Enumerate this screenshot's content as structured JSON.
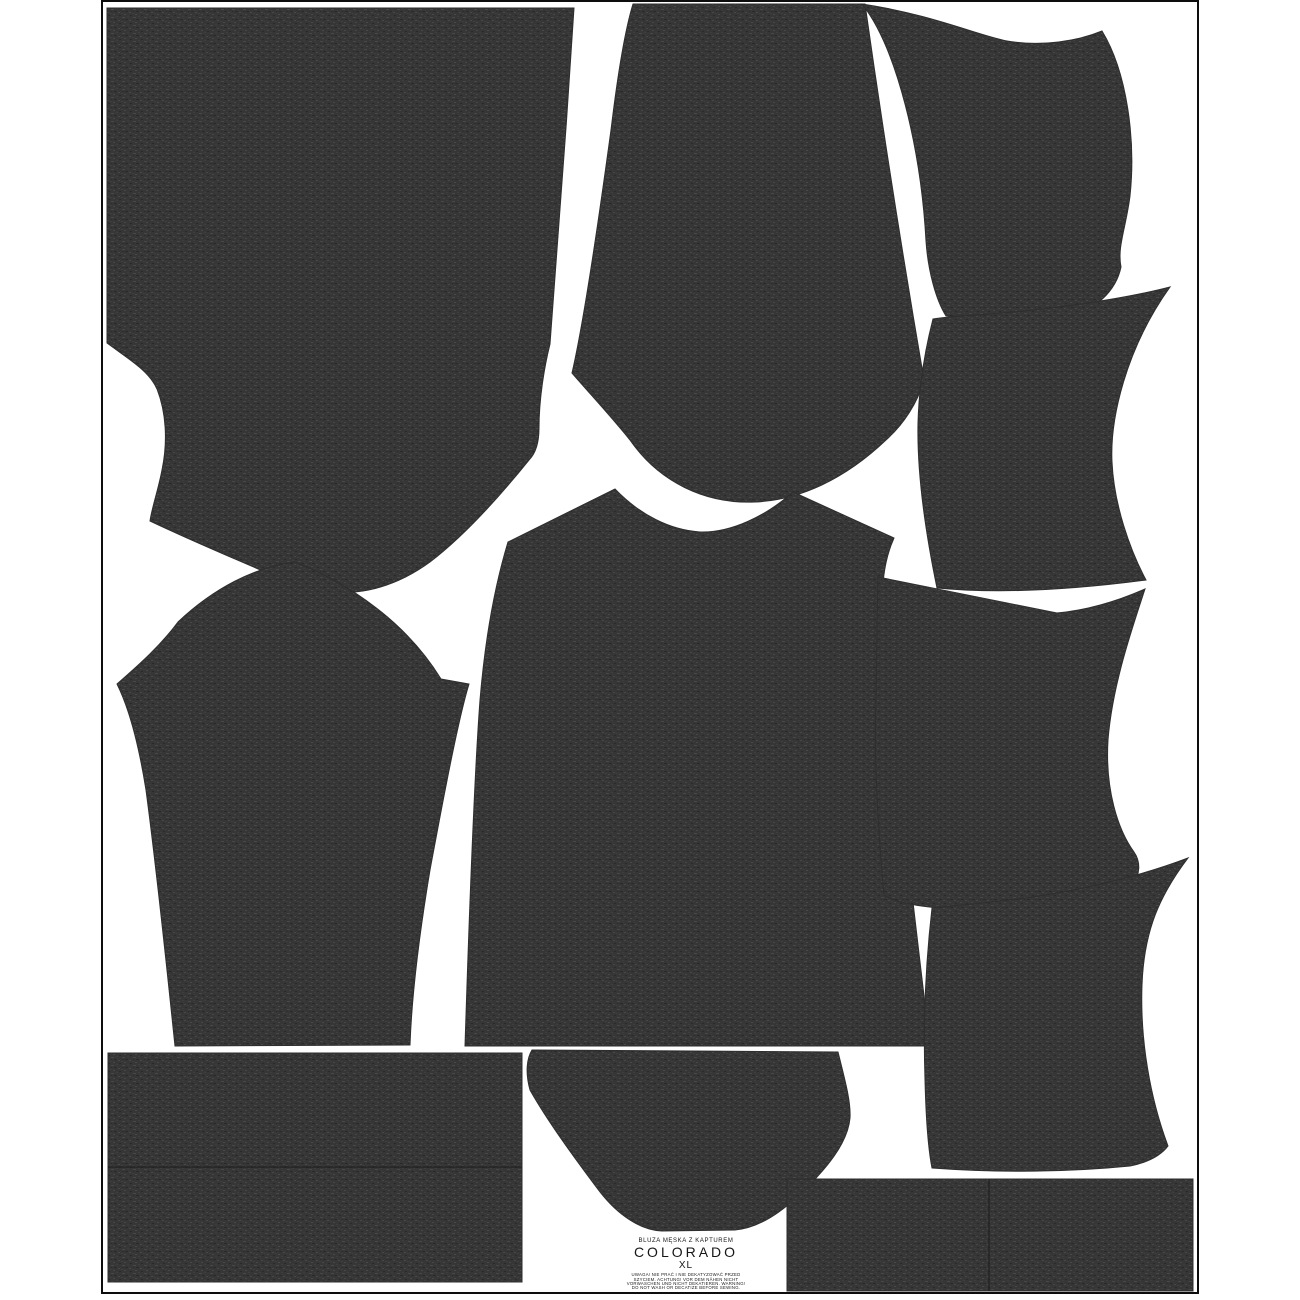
{
  "page": {
    "title": "COLORADO XL cut-and-sew hoodie panel",
    "background_color": "#ffffff",
    "border_color": "#0d0d0d",
    "fabric_base_color": "#363636",
    "fabric_speck_light": "#484848",
    "fabric_speck_mid": "#3e3e3e",
    "fabric_speck_dark": "#2a2a2a",
    "seam_line_color": "#1c1c1c"
  },
  "label_block": {
    "garment": "BLUZA MĘSKA Z KAPTUREM",
    "pattern_name": "COLORADO",
    "size": "XL",
    "care_lines": [
      "UWAGA! NIE PRAĆ I NIE DEKATYZOWAĆ PRZED",
      "SZYCIEM. ACHTUNG! VOR DEM NÄHEN NICHT",
      "VORWASCHEN UND NICHT DEKATIEREN. WARNING!",
      "DO NOT WASH OR DECATIZE BEFORE SEWING."
    ]
  },
  "border": {
    "x": 102,
    "y": 1,
    "width": 1096,
    "height": 1292
  },
  "pieces": [
    {
      "id": "back-panel",
      "path": "M 111,8 L 574,8 C 567,120 558,240 550,344 C 544,368 539,400 539,428 C 539,446 534,455 529,460 C 500,496 464,536 430,562 C 382,597 330,601 281,579 C 243,562 203,546 150,521 C 152,507 158,491 162,470 C 168,441 166,412 157,389 C 149,371 130,360 107,343 L 107,8 Z"
    },
    {
      "id": "front-panel",
      "path": "M 633,4 L 865,4 C 880,110 900,240 924,380 C 918,402 904,424 886,440 C 845,479 800,500 755,502 C 705,504 659,482 630,440 C 609,414 590,394 572,373 C 582,330 596,240 611,130 C 617,80 625,30 633,4 Z"
    },
    {
      "id": "center-panel",
      "path": "M 615,489 C 640,515 670,530 700,532 C 731,533 766,516 793,492 L 894,538 C 884,560 880,590 884,622 C 895,755 915,920 930,1046 L 465,1046 C 469,920 474,780 480,700 C 485,640 495,585 508,542 Z"
    },
    {
      "id": "sleeve",
      "path": "M 295,562 C 350,584 406,622 441,679 L 469,684 C 458,720 443,800 430,870 C 420,930 412,990 410,1045 L 175,1046 C 168,980 158,880 146,790 C 138,740 128,706 117,684 C 140,664 161,645 178,622 C 214,588 255,567 295,562 Z"
    },
    {
      "id": "hood-piece-1",
      "path": "M 862,4 C 930,14 980,36 1007,41 C 1042,47 1078,41 1102,31 C 1127,72 1136,140 1130,196 C 1126,228 1117,247 1121,267 C 1116,291 1096,310 1066,318 C 1025,320 985,318 946,316 C 936,300 928,271 926,241 C 921,150 897,48 862,4 Z"
    },
    {
      "id": "hood-piece-2",
      "path": "M 1170,287 C 1120,300 1040,311 975,315 C 960,316 945,317 933,319 C 925,350 919,385 918,423 C 917,470 925,530 937,588 C 1000,594 1070,590 1146,580 C 1130,550 1114,505 1112,462 C 1110,420 1125,350 1170,287 Z"
    },
    {
      "id": "hood-piece-3",
      "path": "M 878,577 C 940,590 1000,602 1057,613 C 1090,610 1120,600 1145,589 C 1128,640 1112,690 1108,740 C 1105,790 1118,830 1134,852 C 1141,862 1140,875 1133,883 C 1118,897 1090,904 1060,906 L 940,908 C 915,906 895,902 884,895 C 878,830 874,760 876,700 C 877,650 877,610 878,577 Z"
    },
    {
      "id": "hood-piece-4",
      "path": "M 1188,858 C 1130,880 1060,895 1000,901 C 975,904 950,906 932,908 C 926,960 923,1020 925,1080 C 926,1120 928,1148 932,1168 C 1000,1173 1070,1172 1130,1166 C 1150,1162 1162,1154 1168,1146 C 1150,1098 1140,1040 1142,985 C 1144,930 1160,895 1188,858 Z"
    },
    {
      "id": "pocket",
      "path": "M 532,1050 L 838,1052 C 845,1080 851,1102 850,1118 C 848,1142 828,1168 798,1196 C 778,1215 757,1228 735,1230 L 662,1231 C 640,1230 618,1215 600,1192 C 576,1160 548,1122 530,1090 C 525,1072 527,1058 532,1050 Z"
    },
    {
      "id": "waistband",
      "path": "M 108,1053 L 522,1053 L 522,1282 L 108,1282 Z",
      "seam": "M 108,1167 L 522,1167"
    },
    {
      "id": "cuffs",
      "path": "M 787,1179 L 1193,1179 L 1193,1291 L 787,1291 Z",
      "seam": "M 989,1179 L 989,1291"
    }
  ]
}
